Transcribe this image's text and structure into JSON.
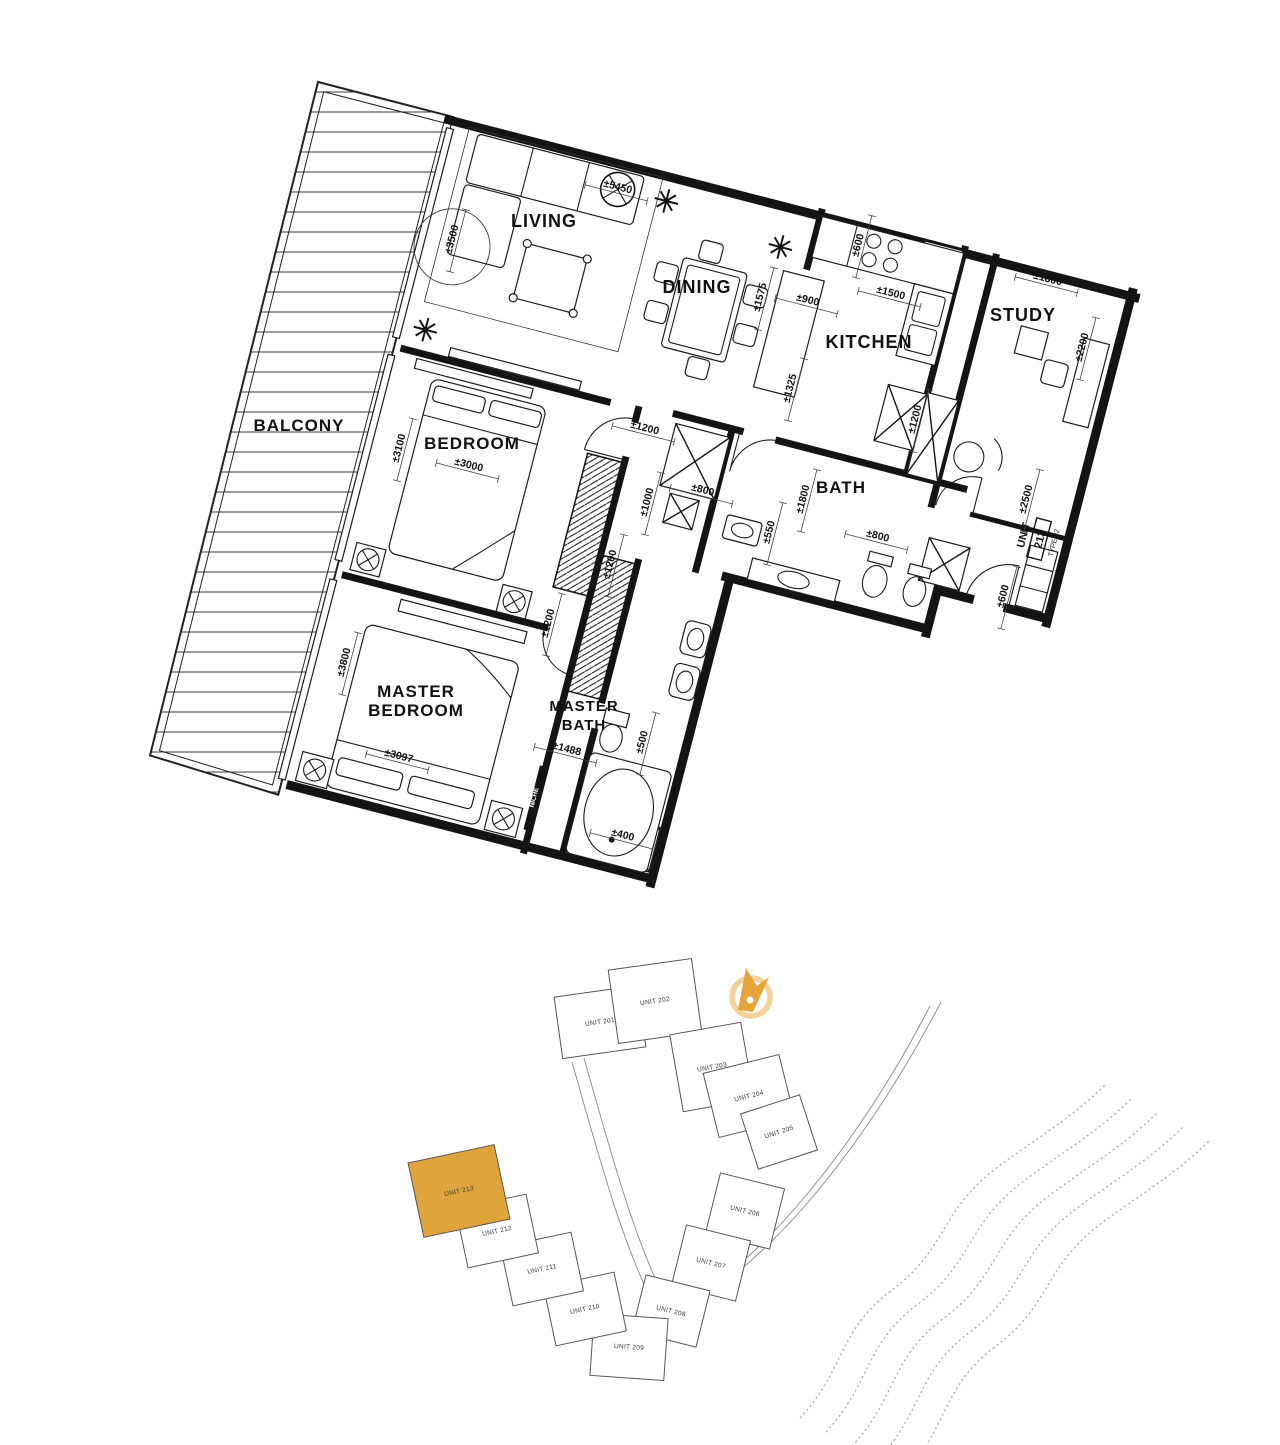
{
  "floor_plan": {
    "niche_label": "NICHE",
    "unit_tag": {
      "unit_word": "UNIT",
      "unit_number": "213",
      "type_label": "TYPE 02"
    },
    "rooms": [
      {
        "label": "LIVING",
        "x": 544,
        "y": 227,
        "size": 18
      },
      {
        "label": "DINING",
        "x": 697,
        "y": 293,
        "size": 18
      },
      {
        "label": "KITCHEN",
        "x": 869,
        "y": 348,
        "size": 18
      },
      {
        "label": "STUDY",
        "x": 1023,
        "y": 321,
        "size": 18
      },
      {
        "label": "BALCONY",
        "x": 299,
        "y": 431,
        "size": 17
      },
      {
        "label": "BEDROOM",
        "x": 472,
        "y": 449,
        "size": 17
      },
      {
        "label": "BATH",
        "x": 841,
        "y": 493,
        "size": 17
      },
      {
        "label": "MASTER BEDROOM",
        "lines": [
          "MASTER",
          "BEDROOM"
        ],
        "x": 416,
        "y": 697,
        "size": 17
      },
      {
        "label": "MASTER BATH",
        "lines": [
          "MASTER",
          "BATH"
        ],
        "x": 584,
        "y": 711,
        "size": 15
      }
    ],
    "dimensions": [
      {
        "t": "±3500",
        "x": 455,
        "y": 240,
        "r": -75.5
      },
      {
        "t": "±5450",
        "x": 617,
        "y": 190,
        "r": 14.5
      },
      {
        "t": "±1575",
        "x": 763,
        "y": 298,
        "r": -75.5
      },
      {
        "t": "±900",
        "x": 807,
        "y": 303,
        "r": 14.5
      },
      {
        "t": "±600",
        "x": 861,
        "y": 246,
        "r": -75.5
      },
      {
        "t": "±1500",
        "x": 890,
        "y": 296,
        "r": 14.5
      },
      {
        "t": "±1800",
        "x": 1047,
        "y": 282,
        "r": 14.5
      },
      {
        "t": "±2200",
        "x": 1085,
        "y": 348,
        "r": -75.5
      },
      {
        "t": "±1325",
        "x": 793,
        "y": 389,
        "r": -75.5
      },
      {
        "t": "±1200",
        "x": 918,
        "y": 420,
        "r": -75.5
      },
      {
        "t": "±1200",
        "x": 644,
        "y": 431,
        "r": 14.5
      },
      {
        "t": "±3000",
        "x": 468,
        "y": 468,
        "r": 14.5
      },
      {
        "t": "±3100",
        "x": 402,
        "y": 449,
        "r": -75.5
      },
      {
        "t": "±1000",
        "x": 650,
        "y": 503,
        "r": -75.5
      },
      {
        "t": "±800",
        "x": 702,
        "y": 493,
        "r": 14.5
      },
      {
        "t": "±550",
        "x": 772,
        "y": 533,
        "r": -75.5
      },
      {
        "t": "±1800",
        "x": 806,
        "y": 500,
        "r": -75.5
      },
      {
        "t": "±800",
        "x": 877,
        "y": 539,
        "r": 14.5
      },
      {
        "t": "±1200",
        "x": 613,
        "y": 565,
        "r": -75.5
      },
      {
        "t": "±1200",
        "x": 551,
        "y": 624,
        "r": -75.5
      },
      {
        "t": "±2500",
        "x": 1029,
        "y": 500,
        "r": -75.5
      },
      {
        "t": "±600",
        "x": 1006,
        "y": 597,
        "r": -75.5
      },
      {
        "t": "±3800",
        "x": 347,
        "y": 663,
        "r": -75.5
      },
      {
        "t": "±3097",
        "x": 398,
        "y": 759,
        "r": 14.5
      },
      {
        "t": "±1488",
        "x": 566,
        "y": 752,
        "r": 14.5
      },
      {
        "t": "±500",
        "x": 645,
        "y": 743,
        "r": -75.5
      },
      {
        "t": "±400",
        "x": 622,
        "y": 838,
        "r": 14.5
      }
    ]
  },
  "site_plan": {
    "highlight_unit": "UNIT 213",
    "highlight_color": "#DFA43B",
    "unit_stroke_color": "#555555",
    "wave_color": "#ABA9C8",
    "compass": {
      "ring_color": "#F4D295",
      "arrow_color": "#E6A33C"
    },
    "units": [
      {
        "label": "UNIT 201",
        "cx": 600,
        "cy": 1022,
        "w": 84,
        "h": 62,
        "rot": -8,
        "highlight": false
      },
      {
        "label": "UNIT 202",
        "cx": 655,
        "cy": 1001,
        "w": 84,
        "h": 74,
        "rot": -8,
        "highlight": false
      },
      {
        "label": "UNIT 203",
        "cx": 712,
        "cy": 1067,
        "w": 72,
        "h": 78,
        "rot": -10,
        "highlight": false
      },
      {
        "label": "UNIT 204",
        "cx": 749,
        "cy": 1096,
        "w": 78,
        "h": 66,
        "rot": -14,
        "highlight": false
      },
      {
        "label": "UNIT 205",
        "cx": 779,
        "cy": 1132,
        "w": 62,
        "h": 58,
        "rot": -18,
        "highlight": false
      },
      {
        "label": "UNIT 206",
        "cx": 745,
        "cy": 1211,
        "w": 66,
        "h": 62,
        "rot": 14,
        "highlight": false
      },
      {
        "label": "UNIT 207",
        "cx": 711,
        "cy": 1263,
        "w": 66,
        "h": 62,
        "rot": 14,
        "highlight": false
      },
      {
        "label": "UNIT 208",
        "cx": 671,
        "cy": 1311,
        "w": 66,
        "h": 58,
        "rot": 14,
        "highlight": false
      },
      {
        "label": "UNIT 209",
        "cx": 629,
        "cy": 1347,
        "w": 74,
        "h": 62,
        "rot": 4,
        "highlight": false
      },
      {
        "label": "UNIT 210",
        "cx": 585,
        "cy": 1309,
        "w": 72,
        "h": 60,
        "rot": -12,
        "highlight": false
      },
      {
        "label": "UNIT 211",
        "cx": 542,
        "cy": 1269,
        "w": 72,
        "h": 60,
        "rot": -12,
        "highlight": false
      },
      {
        "label": "UNIT 212",
        "cx": 497,
        "cy": 1231,
        "w": 72,
        "h": 60,
        "rot": -12,
        "highlight": false
      },
      {
        "label": "UNIT 213",
        "cx": 459,
        "cy": 1191,
        "w": 88,
        "h": 76,
        "rot": -12,
        "highlight": true
      }
    ]
  }
}
